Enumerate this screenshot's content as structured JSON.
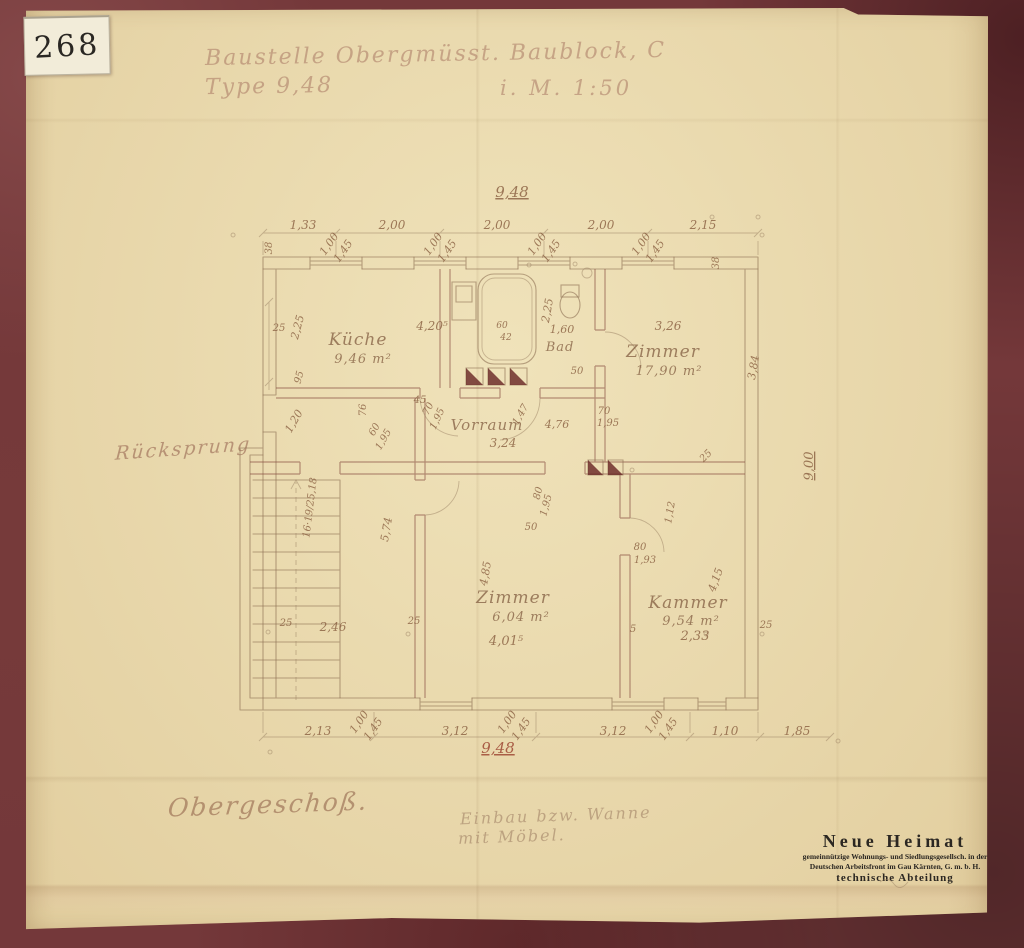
{
  "sticker": {
    "number": "268"
  },
  "header": {
    "line1": "Baustelle Obergmüsst. Baublock, C",
    "line2_left": "Type 9,48",
    "line2_right": "i. M. 1:50"
  },
  "notes": {
    "left_margin": "Rücksprung",
    "floor": "Obergeschoß.",
    "pencil_line1": "Einbau bzw. Wanne",
    "pencil_line2": "mit Möbel."
  },
  "stamp": {
    "line1": "Neue Heimat",
    "line2": "gemeinnützige Wohnungs- und Siedlungsgesellsch. in der",
    "line3": "Deutschen Arbeitsfront im Gau Kärnten, G. m. b. H.",
    "line4": "technische Abteilung"
  },
  "rooms": [
    {
      "name": "Küche",
      "area": "9,46 m²"
    },
    {
      "name": "Zimmer",
      "area": "17,90 m²"
    },
    {
      "name": "Bad",
      "area": ""
    },
    {
      "name": "Vorraum",
      "area": ""
    },
    {
      "name": "Zimmer",
      "area": "6,04 m²"
    },
    {
      "name": "Kammer",
      "area": "9,54 m²"
    }
  ],
  "colors": {
    "mount": "#74383a",
    "paper": "#e9d8ab",
    "pencil": "#8f6b50",
    "red_pencil": "#a14a3a",
    "stamp_ink": "#2b2722"
  },
  "plan": {
    "labels": [
      {
        "t": "9,48",
        "x": 512,
        "y": 197,
        "s": 15,
        "u": 1
      },
      {
        "t": "1,33",
        "x": 303,
        "y": 229,
        "s": 12
      },
      {
        "t": "2,00",
        "x": 392,
        "y": 229,
        "s": 12
      },
      {
        "t": "2,00",
        "x": 497,
        "y": 229,
        "s": 12
      },
      {
        "t": "2,00",
        "x": 601,
        "y": 229,
        "s": 12
      },
      {
        "t": "2,15",
        "x": 703,
        "y": 229,
        "s": 12
      },
      {
        "t": "1,00",
        "x": 332,
        "y": 246,
        "r": -55,
        "s": 11
      },
      {
        "t": "1,45",
        "x": 346,
        "y": 253,
        "r": -55,
        "s": 11
      },
      {
        "t": "1,00",
        "x": 436,
        "y": 246,
        "r": -55,
        "s": 11
      },
      {
        "t": "1,45",
        "x": 450,
        "y": 253,
        "r": -55,
        "s": 11
      },
      {
        "t": "1,00",
        "x": 540,
        "y": 246,
        "r": -55,
        "s": 11
      },
      {
        "t": "1,45",
        "x": 554,
        "y": 253,
        "r": -55,
        "s": 11
      },
      {
        "t": "1,00",
        "x": 644,
        "y": 246,
        "r": -55,
        "s": 11
      },
      {
        "t": "1,45",
        "x": 658,
        "y": 253,
        "r": -55,
        "s": 11
      },
      {
        "t": "38",
        "x": 272,
        "y": 248,
        "r": -90,
        "s": 10
      },
      {
        "t": "38",
        "x": 719,
        "y": 263,
        "r": -90,
        "s": 10
      },
      {
        "t": "25",
        "x": 279,
        "y": 331,
        "s": 10
      },
      {
        "t": "2,25",
        "x": 301,
        "y": 328,
        "r": -75,
        "s": 11
      },
      {
        "t": "95",
        "x": 302,
        "y": 378,
        "r": -75,
        "s": 10
      },
      {
        "t": "1,20",
        "x": 297,
        "y": 423,
        "r": -60,
        "s": 11
      },
      {
        "t": "76",
        "x": 366,
        "y": 410,
        "r": -90,
        "s": 10
      },
      {
        "t": "60",
        "x": 377,
        "y": 431,
        "r": -60,
        "s": 10
      },
      {
        "t": "1,95",
        "x": 386,
        "y": 441,
        "r": -60,
        "s": 10
      },
      {
        "t": "16·19/25,18",
        "x": 313,
        "y": 508,
        "r": -83,
        "s": 10
      },
      {
        "t": "5,74",
        "x": 390,
        "y": 530,
        "r": -80,
        "s": 11
      },
      {
        "t": "25",
        "x": 286,
        "y": 626,
        "s": 10
      },
      {
        "t": "2,46",
        "x": 333,
        "y": 631,
        "s": 12
      },
      {
        "t": "25",
        "x": 414,
        "y": 624,
        "s": 10
      },
      {
        "t": "Küche",
        "x": 358,
        "y": 345,
        "s": 17,
        "cls": "room"
      },
      {
        "t": "9,46 m²",
        "x": 363,
        "y": 363,
        "s": 13,
        "cls": "room"
      },
      {
        "t": "4,20⁵",
        "x": 432,
        "y": 330,
        "s": 12
      },
      {
        "t": "45",
        "x": 420,
        "y": 403,
        "s": 10
      },
      {
        "t": "70",
        "x": 431,
        "y": 410,
        "r": -65,
        "s": 10
      },
      {
        "t": "1,95",
        "x": 440,
        "y": 420,
        "r": -65,
        "s": 10
      },
      {
        "t": "60",
        "x": 502,
        "y": 328,
        "s": 9
      },
      {
        "t": "42",
        "x": 506,
        "y": 340,
        "s": 9
      },
      {
        "t": "2,25",
        "x": 551,
        "y": 311,
        "r": -80,
        "s": 11
      },
      {
        "t": "1,60",
        "x": 562,
        "y": 333,
        "s": 11
      },
      {
        "t": "Bad",
        "x": 560,
        "y": 351,
        "s": 13,
        "cls": "room"
      },
      {
        "t": "50",
        "x": 577,
        "y": 374,
        "s": 10
      },
      {
        "t": "3,26",
        "x": 668,
        "y": 330,
        "s": 12
      },
      {
        "t": "Zimmer",
        "x": 663,
        "y": 357,
        "s": 17,
        "cls": "room"
      },
      {
        "t": "17,90 m²",
        "x": 669,
        "y": 375,
        "s": 13,
        "cls": "room"
      },
      {
        "t": "3,84",
        "x": 757,
        "y": 368,
        "r": -80,
        "s": 11
      },
      {
        "t": "25",
        "x": 708,
        "y": 458,
        "r": -45,
        "s": 10
      },
      {
        "t": "70",
        "x": 604,
        "y": 414,
        "s": 10
      },
      {
        "t": "1,95",
        "x": 608,
        "y": 426,
        "s": 10
      },
      {
        "t": "9,00",
        "x": 813,
        "y": 466,
        "r": -90,
        "s": 13,
        "u": 1
      },
      {
        "t": "Vorraum",
        "x": 487,
        "y": 430,
        "s": 15,
        "cls": "room"
      },
      {
        "t": "1,47",
        "x": 523,
        "y": 416,
        "r": -60,
        "s": 10
      },
      {
        "t": "4,76",
        "x": 557,
        "y": 428,
        "s": 11
      },
      {
        "t": "3,24",
        "x": 503,
        "y": 447,
        "s": 12
      },
      {
        "t": "80",
        "x": 541,
        "y": 494,
        "r": -75,
        "s": 10
      },
      {
        "t": "1,95",
        "x": 549,
        "y": 506,
        "r": -75,
        "s": 10
      },
      {
        "t": "50",
        "x": 531,
        "y": 530,
        "s": 10
      },
      {
        "t": "80",
        "x": 640,
        "y": 550,
        "s": 10
      },
      {
        "t": "1,93",
        "x": 645,
        "y": 563,
        "s": 10
      },
      {
        "t": "1,12",
        "x": 673,
        "y": 513,
        "r": -80,
        "s": 10
      },
      {
        "t": "4,85",
        "x": 489,
        "y": 574,
        "r": -80,
        "s": 11
      },
      {
        "t": "Zimmer",
        "x": 513,
        "y": 603,
        "s": 17,
        "cls": "room"
      },
      {
        "t": "6,04 m²",
        "x": 521,
        "y": 621,
        "s": 13,
        "cls": "room"
      },
      {
        "t": "4,01⁵",
        "x": 506,
        "y": 645,
        "s": 13
      },
      {
        "t": "4,15",
        "x": 719,
        "y": 581,
        "r": -70,
        "s": 11
      },
      {
        "t": "Kammer",
        "x": 688,
        "y": 608,
        "s": 17,
        "cls": "room"
      },
      {
        "t": "9,54 m²",
        "x": 691,
        "y": 625,
        "s": 13,
        "cls": "room"
      },
      {
        "t": "2,33",
        "x": 695,
        "y": 640,
        "s": 13
      },
      {
        "t": "5",
        "x": 633,
        "y": 632,
        "s": 10
      },
      {
        "t": "25",
        "x": 766,
        "y": 628,
        "s": 10
      },
      {
        "t": "2,13",
        "x": 318,
        "y": 735,
        "s": 12
      },
      {
        "t": "3,12",
        "x": 455,
        "y": 735,
        "s": 12
      },
      {
        "t": "3,12",
        "x": 613,
        "y": 735,
        "s": 12
      },
      {
        "t": "1,10",
        "x": 725,
        "y": 735,
        "s": 12
      },
      {
        "t": "1,85",
        "x": 797,
        "y": 735,
        "s": 12
      },
      {
        "t": "1,00",
        "x": 362,
        "y": 724,
        "r": -55,
        "s": 11
      },
      {
        "t": "1,45",
        "x": 376,
        "y": 731,
        "r": -55,
        "s": 11
      },
      {
        "t": "1,00",
        "x": 510,
        "y": 724,
        "r": -55,
        "s": 11
      },
      {
        "t": "1,45",
        "x": 524,
        "y": 731,
        "r": -55,
        "s": 11
      },
      {
        "t": "1,00",
        "x": 657,
        "y": 724,
        "r": -55,
        "s": 11
      },
      {
        "t": "1,45",
        "x": 671,
        "y": 731,
        "r": -55,
        "s": 11
      },
      {
        "t": "9,48",
        "x": 498,
        "y": 753,
        "s": 15,
        "cls": "red",
        "u": 1
      }
    ]
  }
}
